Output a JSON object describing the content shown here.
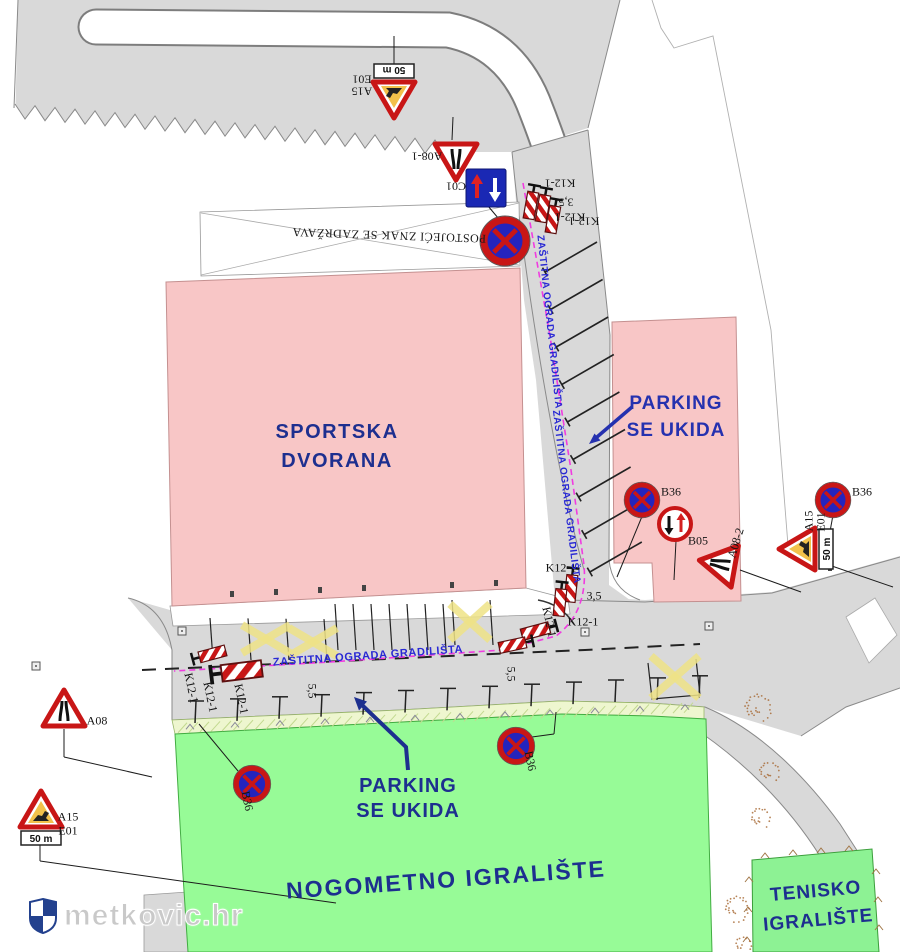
{
  "annotations": {
    "sportska_line1": "SPORTSKA",
    "sportska_line2": "DVORANA",
    "parking_right_line1": "PARKING",
    "parking_right_line2": "SE UKIDA",
    "parking_bottom_line1": "PARKING",
    "parking_bottom_line2": "SE UKIDA",
    "nogometno": "NOGOMETNO IGRALIŠTE",
    "tenisko_line1": "TENISKO",
    "tenisko_line2": "IGRALIŠTE",
    "postojeci": "POSTOJEĆI ZNAK SE ZADRŽAVA",
    "fence_upper": "ZAŠTITNA OGRADA GRADILIŠTA",
    "fence_lower": "ZAŠTITNA OGRADA GRADILIŠTA",
    "fence_horizontal": "ZAŠTITNA OGRADA GRADILIŠTA",
    "watermark": "metkovic.hr",
    "plate_50m": "50 m"
  },
  "sign_labels": [
    {
      "text": "E01",
      "x": 362,
      "y": 79,
      "rot": 180
    },
    {
      "text": "A15",
      "x": 362,
      "y": 91,
      "rot": 180
    },
    {
      "text": "A08-1",
      "x": 427,
      "y": 156,
      "rot": 180
    },
    {
      "text": "C01",
      "x": 456,
      "y": 186,
      "rot": 180
    },
    {
      "text": "K12-1",
      "x": 560,
      "y": 183,
      "rot": 180
    },
    {
      "text": "3,5",
      "x": 566,
      "y": 202,
      "rot": 180
    },
    {
      "text": "K12-1",
      "x": 570,
      "y": 217,
      "rot": 180
    },
    {
      "text": "K12-1",
      "x": 584,
      "y": 221,
      "rot": 180
    },
    {
      "text": "B36",
      "x": 671,
      "y": 492,
      "rot": 0
    },
    {
      "text": "B05",
      "x": 698,
      "y": 541,
      "rot": 0
    },
    {
      "text": "A08-2",
      "x": 736,
      "y": 543,
      "rot": -73
    },
    {
      "text": "B36",
      "x": 862,
      "y": 492,
      "rot": 0
    },
    {
      "text": "A15",
      "x": 809,
      "y": 521,
      "rot": -90
    },
    {
      "text": "E01",
      "x": 821,
      "y": 522,
      "rot": -90
    },
    {
      "text": "A08",
      "x": 97,
      "y": 721,
      "rot": 0
    },
    {
      "text": "A15",
      "x": 68,
      "y": 817,
      "rot": 0
    },
    {
      "text": "E01",
      "x": 68,
      "y": 831,
      "rot": 0
    },
    {
      "text": "K12-1",
      "x": 191,
      "y": 688,
      "rot": 78
    },
    {
      "text": "K12-1",
      "x": 210,
      "y": 697,
      "rot": 78
    },
    {
      "text": "K12-1",
      "x": 241,
      "y": 699,
      "rot": 78
    },
    {
      "text": "K12-1",
      "x": 561,
      "y": 568,
      "rot": 0
    },
    {
      "text": "3,5",
      "x": 594,
      "y": 596,
      "rot": 0
    },
    {
      "text": "K12-1",
      "x": 583,
      "y": 622,
      "rot": 0
    },
    {
      "text": "K12-1",
      "x": 549,
      "y": 622,
      "rot": 78
    },
    {
      "text": "5,5",
      "x": 312,
      "y": 691,
      "rot": 90
    },
    {
      "text": "5,5",
      "x": 511,
      "y": 674,
      "rot": 90
    },
    {
      "text": "B36",
      "x": 247,
      "y": 801,
      "rot": 78
    },
    {
      "text": "B36",
      "x": 530,
      "y": 761,
      "rot": 78
    }
  ],
  "signs": [
    {
      "type": "a15e01",
      "x": 394,
      "y": 96,
      "rot": 180,
      "scale": 1
    },
    {
      "type": "a08",
      "x": 456,
      "y": 158,
      "rot": 180,
      "scale": 1
    },
    {
      "type": "c01",
      "x": 486,
      "y": 188,
      "rot": 0,
      "scale": 1
    },
    {
      "type": "k12",
      "x": 531,
      "y": 205,
      "rot": 10,
      "scale": 1
    },
    {
      "type": "k12",
      "x": 543,
      "y": 208,
      "rot": 10,
      "scale": 1
    },
    {
      "type": "k12",
      "x": 553,
      "y": 219,
      "rot": 10,
      "scale": 1
    },
    {
      "type": "b36",
      "x": 505,
      "y": 241,
      "rot": 0,
      "scale": 1.4
    },
    {
      "type": "b36",
      "x": 642,
      "y": 500,
      "rot": 0,
      "scale": 1
    },
    {
      "type": "b05",
      "x": 675,
      "y": 524,
      "rot": 0,
      "scale": 1
    },
    {
      "type": "a08",
      "x": 721,
      "y": 564,
      "rot": -80,
      "scale": 1
    },
    {
      "type": "b36",
      "x": 833,
      "y": 500,
      "rot": 0,
      "scale": 1
    },
    {
      "type": "a15e01",
      "x": 801,
      "y": 549,
      "rot": -90,
      "scale": 1
    },
    {
      "type": "a08",
      "x": 64,
      "y": 712,
      "rot": 0,
      "scale": 1
    },
    {
      "type": "a15e01",
      "x": 41,
      "y": 813,
      "rot": 0,
      "scale": 1
    },
    {
      "type": "b36",
      "x": 252,
      "y": 784,
      "rot": 0,
      "scale": 1.05
    },
    {
      "type": "b36",
      "x": 516,
      "y": 746,
      "rot": 0,
      "scale": 1.05
    },
    {
      "type": "k12",
      "x": 571,
      "y": 588,
      "rot": 6,
      "scale": 1
    },
    {
      "type": "k12",
      "x": 560,
      "y": 602,
      "rot": 6,
      "scale": 1
    },
    {
      "type": "k12",
      "x": 536,
      "y": 631,
      "rot": 75,
      "scale": 1.05
    },
    {
      "type": "k12",
      "x": 513,
      "y": 645,
      "rot": 78,
      "scale": 1
    },
    {
      "type": "k12",
      "x": 212,
      "y": 654,
      "rot": -105,
      "scale": 1
    },
    {
      "type": "k12",
      "x": 241,
      "y": 671,
      "rot": -97,
      "scale": 1.5
    }
  ],
  "colors": {
    "road": "#d9d9d9",
    "road_edge": "#8a8a8a",
    "building_fill": "#f8c6c6",
    "building_edge": "#c49090",
    "field_fill": "#97fb97",
    "tennis_fill": "#8df294",
    "field_edge": "#42ac42",
    "strip_fill": "#eef6cf",
    "fence_magenta": "#f03ce0",
    "navy": "#1d2f8f",
    "parking_blue": "#2531af",
    "fence_blue": "#2929d4",
    "sign_red": "#c81616",
    "sign_blue": "#2424bd",
    "yellow_x": "#efe387",
    "stipple": "#a5652e"
  }
}
